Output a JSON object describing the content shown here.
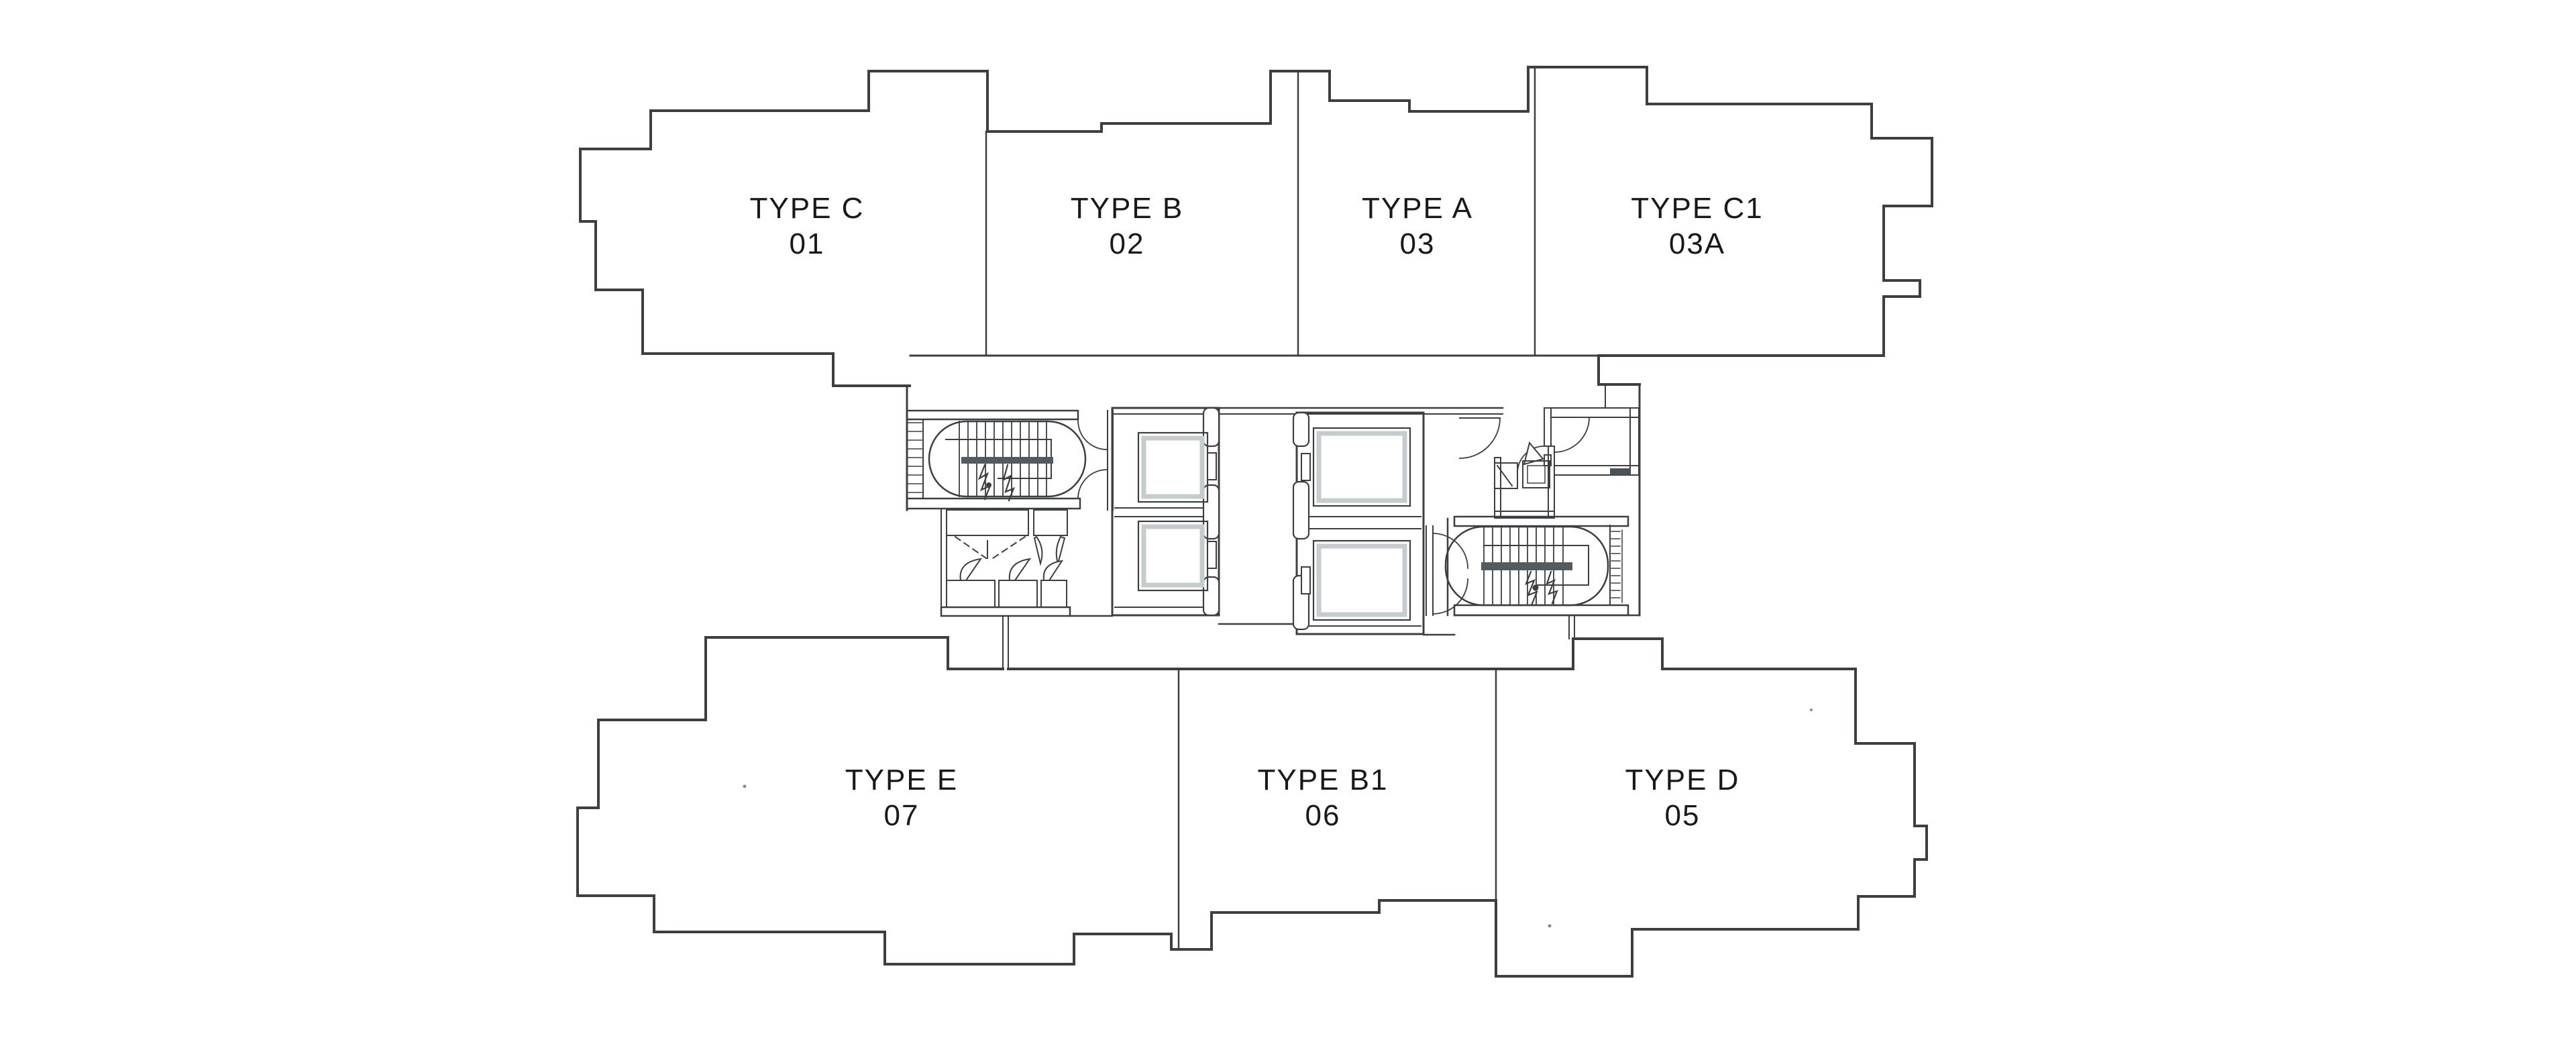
{
  "palette": {
    "background": "#ffffff",
    "line": "#3b3f42",
    "line_light": "#9aa0a4",
    "stair_landing_fill": "#545b5f",
    "elevator_car_frame": "#c6cbcd",
    "hatch_fill": "#4a5257",
    "label_text": "#191919"
  },
  "floor_plan": {
    "units": [
      {
        "id": "c",
        "type": "TYPE C",
        "number": "01"
      },
      {
        "id": "b",
        "type": "TYPE B",
        "number": "02"
      },
      {
        "id": "a",
        "type": "TYPE A",
        "number": "03"
      },
      {
        "id": "c1",
        "type": "TYPE C1",
        "number": "03A"
      },
      {
        "id": "e",
        "type": "TYPE E",
        "number": "07"
      },
      {
        "id": "b1",
        "type": "TYPE B1",
        "number": "06"
      },
      {
        "id": "d",
        "type": "TYPE D",
        "number": "05"
      }
    ],
    "core_features": [
      "staircase-west",
      "staircase-east",
      "elevator-bank-west",
      "elevator-bank-east",
      "lift-lobby",
      "wc-room",
      "service-ducts"
    ]
  }
}
